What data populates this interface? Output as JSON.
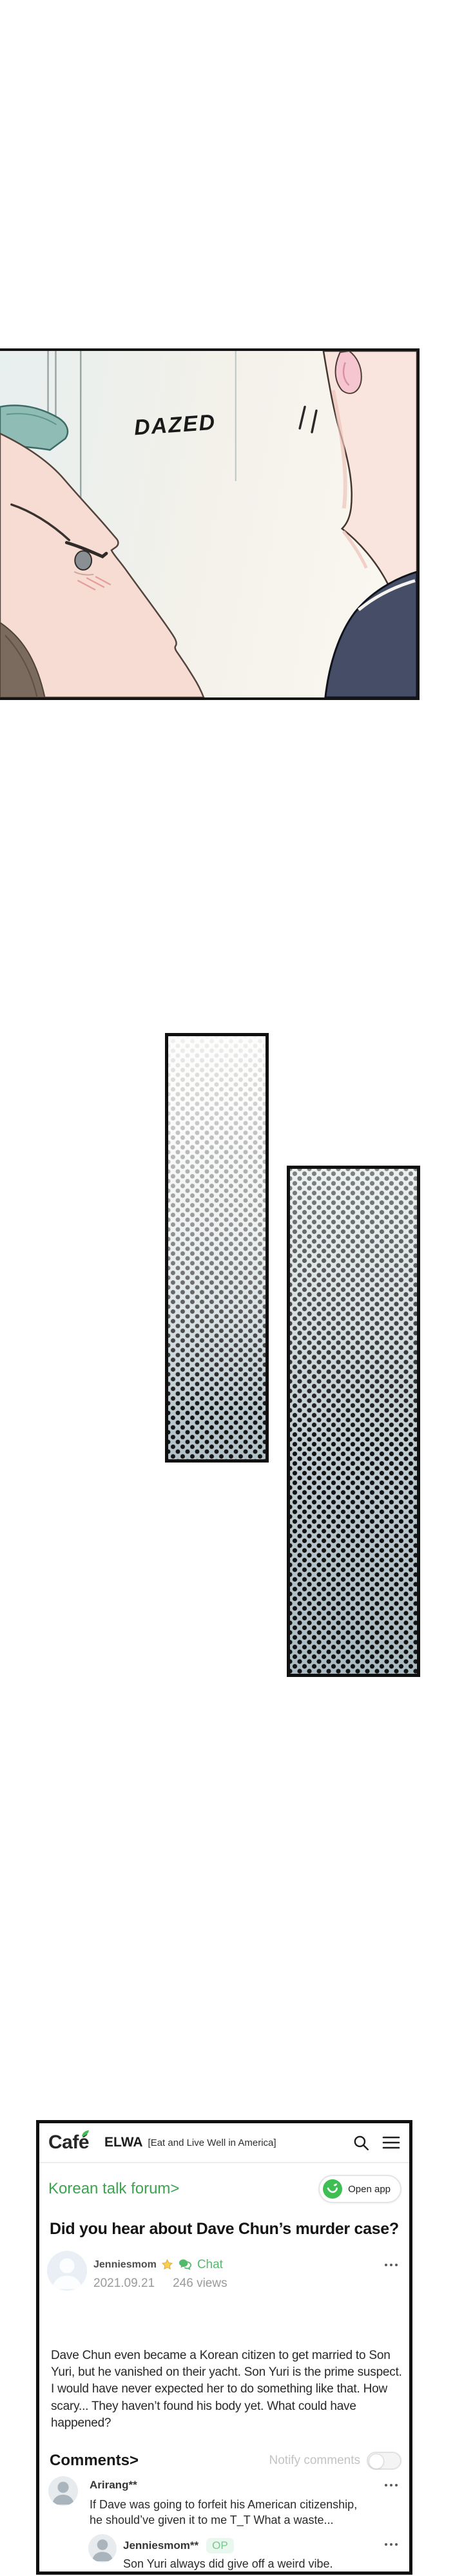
{
  "panel": {
    "sfx": "DAZED"
  },
  "cafe": {
    "header": {
      "logo": "Café",
      "board": "ELWA",
      "board_subtitle": "[Eat and Live Well in America]"
    },
    "forum_link": "Korean talk forum>",
    "open_app_label": "Open app",
    "post": {
      "title": "Did you hear about Dave Chun’s murder case?",
      "author": "Jenniesmom",
      "chat_label": "Chat",
      "date": "2021.09.21",
      "views": "246 views",
      "body": "Dave Chun even became a Korean citizen to get married to Son Yuri, but he vanished on their yacht. Son Yuri is the prime suspect. I would have never expected her to do something like that. How scary... They haven’t found his body yet. What could have happened?"
    },
    "comments": {
      "heading": "Comments>",
      "notify_label": "Notify comments",
      "items": [
        {
          "author": "Arirang**",
          "text": "If Dave was going to forfeit his American citizenship, he should’ve given it to me T_T What a waste..."
        },
        {
          "author": "Jenniesmom**",
          "op_badge": "OP",
          "text": "Son Yuri always did give off a weird vibe."
        }
      ]
    }
  },
  "colors": {
    "accent_green": "#3fbf53",
    "link_green": "#3da351",
    "chat_green": "#55bb6b",
    "star_gold": "#f8cf51",
    "star_gold_edge": "#e3a83e",
    "op_badge_bg": "#e9f7ee",
    "op_badge_text": "#74ca8e",
    "card_border": "#101010",
    "teal": "#8fbcb5",
    "skin": "#f7dcd3",
    "navy": "#454e66"
  }
}
